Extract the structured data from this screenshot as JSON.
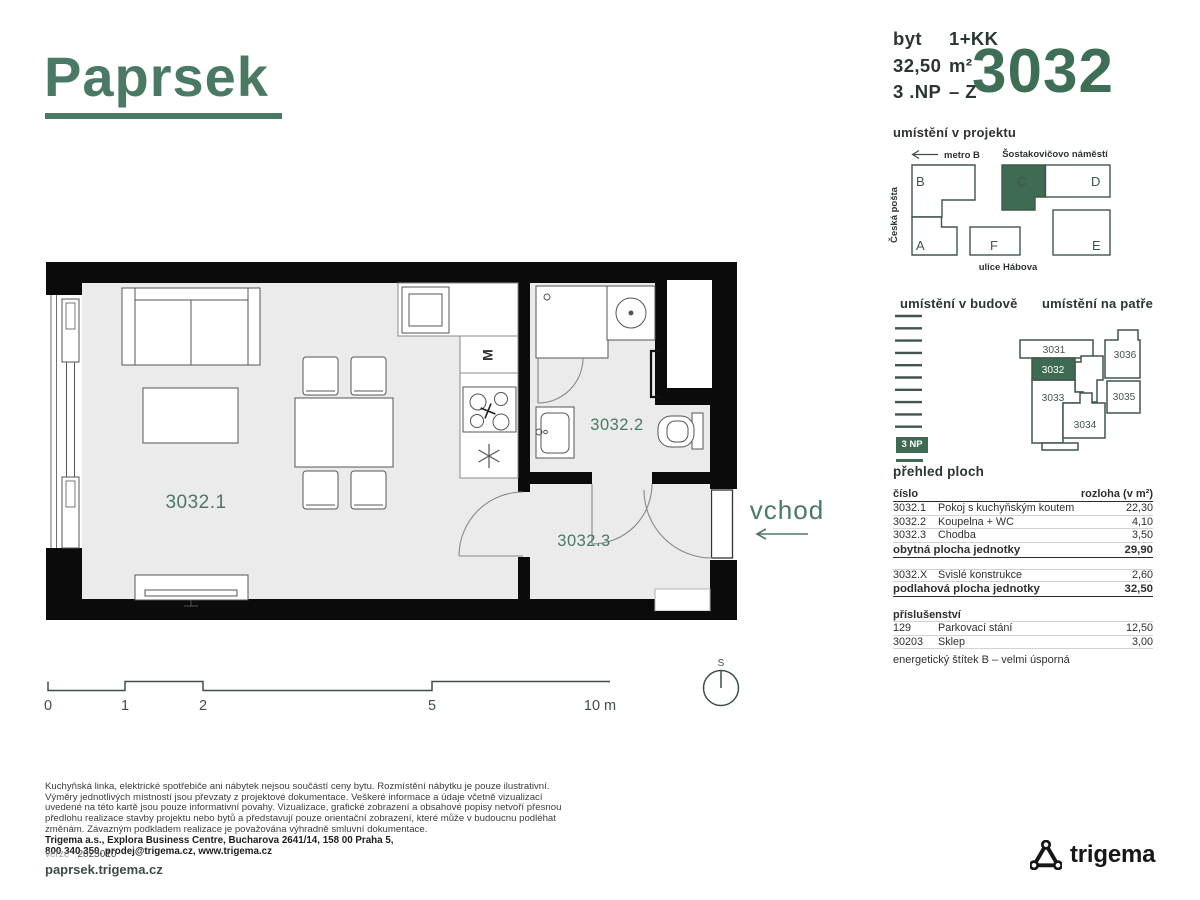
{
  "colors": {
    "brand_green": "#4b7a64",
    "fill_green": "#3e6b52",
    "unit_number_green": "#3f6e57",
    "dark_text": "#2b3630",
    "wall_black": "#0b0b0b",
    "floor_gray": "#ebebeb"
  },
  "logo": {
    "text": "Paprsek"
  },
  "unit_header": {
    "type_label": "byt",
    "type_value": "1+KK",
    "area_label": "32,50",
    "area_value": "m²",
    "floor_label": "3 .NP",
    "floor_value": "– Z",
    "unit_number": "3032"
  },
  "site_map": {
    "title": "umístění v projektu",
    "metro": "metro B",
    "square": "Šostakovičovo náměstí",
    "left_label": "Česká pošta",
    "street": "ulice Hábova",
    "blocks": {
      "a": "A",
      "b": "B",
      "c": "C",
      "d": "D",
      "e": "E",
      "f": "F"
    }
  },
  "building": {
    "title": "umístění v budově",
    "badge": "3 NP"
  },
  "floor_plate": {
    "title": "umístění na patře",
    "units": {
      "u3031": "3031",
      "u3032": "3032",
      "u3033": "3033",
      "u3034": "3034",
      "u3035": "3035",
      "u3036": "3036"
    }
  },
  "areas": {
    "title": "přehled ploch",
    "col_number": "číslo",
    "col_area": "rozloha (v m²)",
    "rows": [
      {
        "num": "3032.1",
        "name": "Pokoj s kuchyňským koutem",
        "value": "22,30"
      },
      {
        "num": "3032.2",
        "name": "Koupelna + WC",
        "value": "4,10"
      },
      {
        "num": "3032.3",
        "name": "Chodba",
        "value": "3,50"
      }
    ],
    "total1": {
      "name": "obytná plocha jednotky",
      "value": "29,90"
    },
    "extra_row": {
      "num": "3032.X",
      "name": "Svislé konstrukce",
      "value": "2,60"
    },
    "total2": {
      "name": "podlahová plocha jednotky",
      "value": "32,50"
    },
    "accessories_title": "příslušenství",
    "accessories": [
      {
        "num": "129",
        "name": "Parkovací stání",
        "value": "12,50"
      },
      {
        "num": "30203",
        "name": "Sklep",
        "value": "3,00"
      }
    ],
    "energy_note": "energetický štítek B – velmi úsporná"
  },
  "plan": {
    "room1": "3032.1",
    "room2": "3032.2",
    "room3": "3032.3",
    "entrance_label": "vchod",
    "appliance_m": "M",
    "compass": "S",
    "scale": {
      "t0": "0",
      "t1": "1",
      "t2": "2",
      "t5": "5",
      "t10": "10 m"
    }
  },
  "footer": {
    "disclaimer": "Kuchyňská linka, elektrické spotřebiče ani nábytek nejsou součástí ceny bytu. Rozmístění nábytku je pouze ilustrativní. Výměry jednotlivých místností jsou převzaty z projektové dokumentace. Veškeré informace a údaje včetně vizualizací uvedené na této kartě jsou pouze informativní povahy. Vizualizace, grafické zobrazení a obsahové popisy netvoří přesnou předlohu realizace stavby projektu nebo bytů a představují pouze orientační zobrazení, které může v budoucnu podléhat změnám. Závazným podkladem realizace je považována výhradně smluvní dokumentace.",
    "address_line1": "Trigema a.s., Explora Business Centre, Bucharova 2641/14, 158 00 Praha 5,",
    "address_line2": "800 340 350, prodej@trigema.cz, www.trigema.cz",
    "version_label": "verze",
    "version_value": "2025010",
    "website": "paprsek.trigema.cz",
    "company_logo_text": "trigema"
  }
}
